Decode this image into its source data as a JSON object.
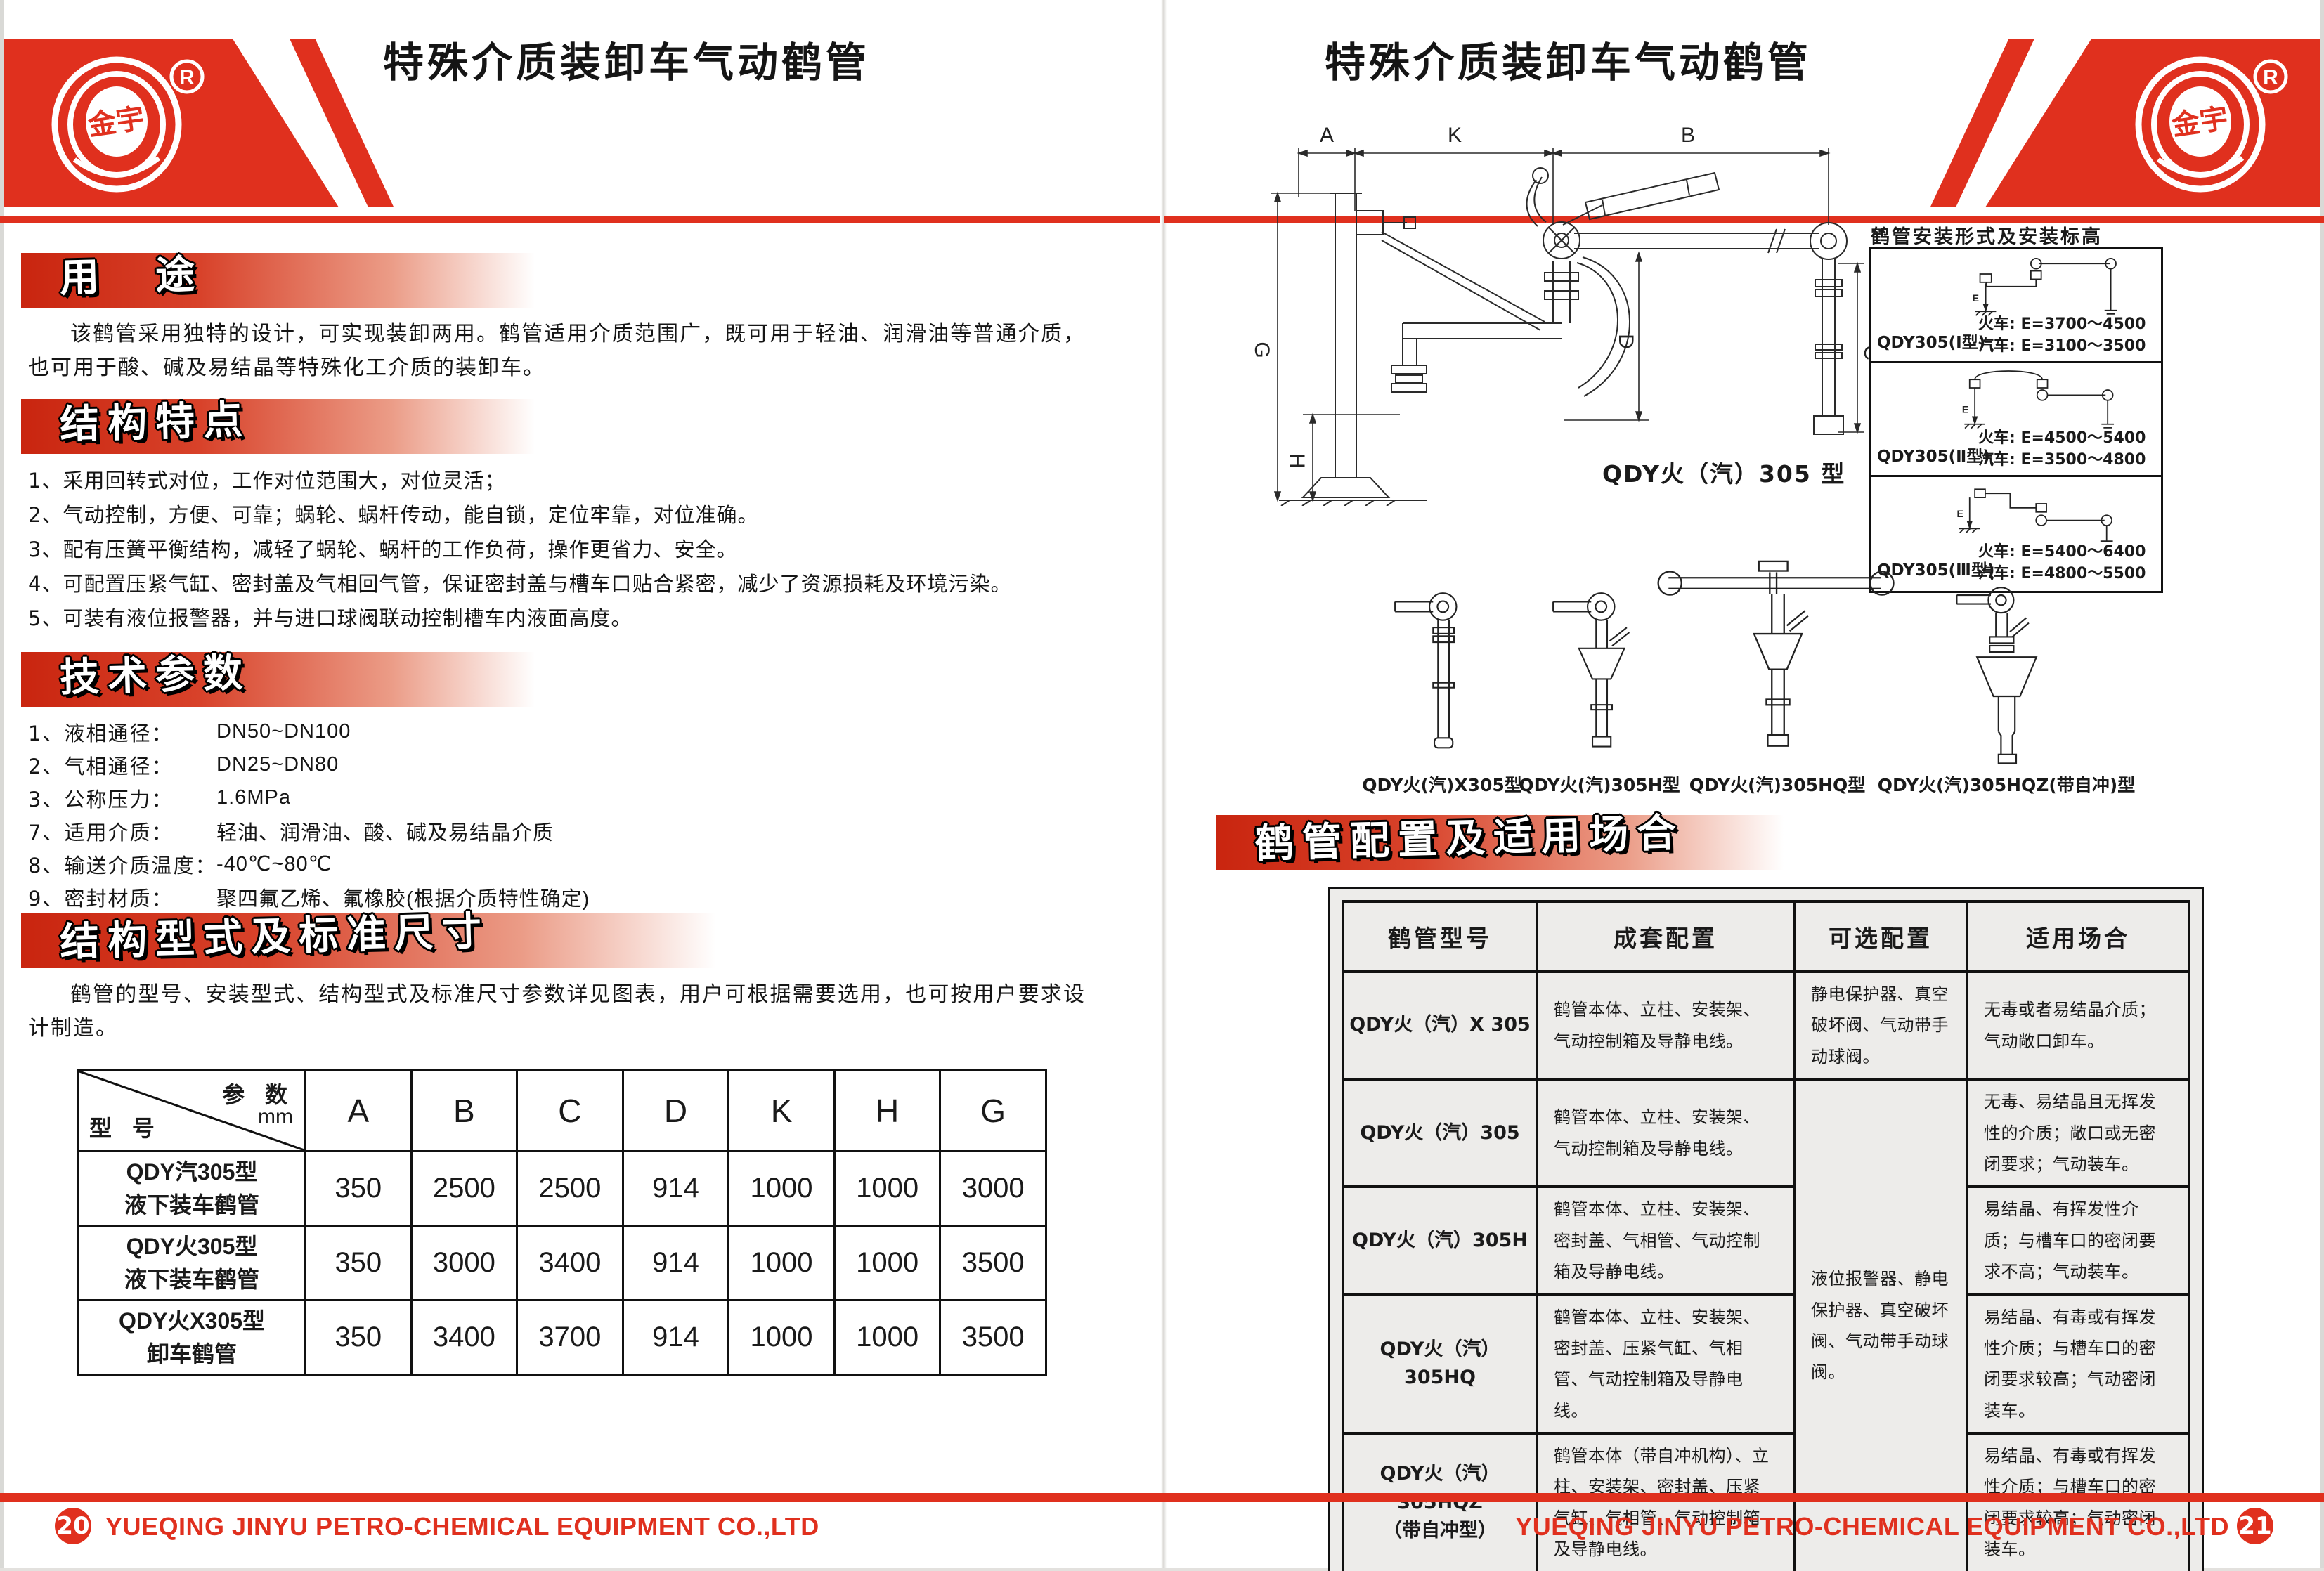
{
  "colors": {
    "accent_red": "#e0301e",
    "section_bar_red": "#c9250f",
    "table_gray": "#edecea",
    "line_black": "#111111"
  },
  "brand": {
    "logo_text": "金宇",
    "registered_mark": "R"
  },
  "left": {
    "title": "特殊介质装卸车气动鹤管",
    "usage": {
      "title": "用　途",
      "text": "该鹤管采用独特的设计，可实现装卸两用。鹤管适用介质范围广，既可用于轻油、润滑油等普通介质，也可用于酸、碱及易结晶等特殊化工介质的装卸车。"
    },
    "features": {
      "title": "结构特点",
      "items": [
        "1、采用回转式对位，工作对位范围大，对位灵活；",
        "2、气动控制，方便、可靠；蜗轮、蜗杆传动，能自锁，定位牢靠，对位准确。",
        "3、配有压簧平衡结构，减轻了蜗轮、蜗杆的工作负荷，操作更省力、安全。",
        "4、可配置压紧气缸、密封盖及气相回气管，保证密封盖与槽车口贴合紧密，减少了资源损耗及环境污染。",
        "5、可装有液位报警器，并与进口球阀联动控制槽车内液面高度。"
      ]
    },
    "params": {
      "title": "技术参数",
      "rows": [
        {
          "label": "1、液相通径：",
          "value": "DN50~DN100"
        },
        {
          "label": "2、气相通径：",
          "value": "DN25~DN80"
        },
        {
          "label": "3、公称压力：",
          "value": "1.6MPa"
        },
        {
          "label": "7、适用介质：",
          "value": "轻油、润滑油、酸、碱及易结晶介质"
        },
        {
          "label": "8、输送介质温度：",
          "value": "-40℃~80℃"
        },
        {
          "label": "9、密封材质：",
          "value": "聚四氟乙烯、氟橡胶(根据介质特性确定)"
        }
      ]
    },
    "structure": {
      "title": "结构型式及标准尺寸",
      "text": "鹤管的型号、安装型式、结构型式及标准尺寸参数详见图表，用户可根据需要选用，也可按用户要求设计制造。"
    },
    "dim_table": {
      "corner_top": "参 数",
      "corner_unit": "mm",
      "corner_bottom": "型 号",
      "columns": [
        "A",
        "B",
        "C",
        "D",
        "K",
        "H",
        "G"
      ],
      "rows": [
        {
          "model": "QDY汽305型\n液下装车鹤管",
          "values": [
            "350",
            "2500",
            "2500",
            "914",
            "1000",
            "1000",
            "3000"
          ]
        },
        {
          "model": "QDY火305型\n液下装车鹤管",
          "values": [
            "350",
            "3000",
            "3400",
            "914",
            "1000",
            "1000",
            "3500"
          ]
        },
        {
          "model": "QDY火X305型\n卸车鹤管",
          "values": [
            "350",
            "3400",
            "3700",
            "914",
            "1000",
            "1000",
            "3500"
          ]
        }
      ]
    },
    "footer": {
      "page": "20",
      "company": "YUEQING JINYU PETRO-CHEMICAL EQUIPMENT CO.,LTD"
    }
  },
  "right": {
    "title": "特殊介质装卸车气动鹤管",
    "drawing": {
      "caption": "QDY火（汽）305 型",
      "dim_a": "A",
      "dim_k": "K",
      "dim_b": "B",
      "dim_c": "C",
      "dim_d": "D",
      "dim_h": "H",
      "dim_g": "G"
    },
    "install": {
      "title": "鹤管安装形式及安装标高",
      "e_label": "E",
      "panels": [
        {
          "model": "QDY305(Ⅰ型)",
          "train": "火车: E=3700～4500",
          "truck": "汽车: E=3100～3500"
        },
        {
          "model": "QDY305(Ⅱ型)",
          "train": "火车: E=4500～5400",
          "truck": "汽车: E=3500～4800"
        },
        {
          "model": "QDY305(Ⅲ型)",
          "train": "火车: E=5400～6400",
          "truck": "汽车: E=4800～5500"
        }
      ]
    },
    "variants": {
      "labels": [
        "QDY火(汽)X305型",
        "QDY火(汽)305H型",
        "QDY火(汽)305HQ型",
        "QDY火(汽)305HQZ(带自冲)型"
      ]
    },
    "config": {
      "title": "鹤管配置及适用场合",
      "headers": [
        "鹤管型号",
        "成套配置",
        "可选配置",
        "适用场合"
      ],
      "rows": [
        {
          "model": "QDY火（汽）X 305",
          "set": "鹤管本体、立柱、安装架、气动控制箱及导静电线。",
          "optional": "静电保护器、真空破坏阀、气动带手动球阀。",
          "usage": "无毒或者易结晶介质；气动敞口卸车。"
        },
        {
          "model": "QDY火（汽）305",
          "set": "鹤管本体、立柱、安装架、气动控制箱及导静电线。",
          "usage": "无毒、易结晶且无挥发性的介质；敞口或无密闭要求；气动装车。"
        },
        {
          "model": "QDY火（汽）305H",
          "set": "鹤管本体、立柱、安装架、密封盖、气相管、气动控制箱及导静电线。",
          "usage": "易结晶、有挥发性介质；与槽车口的密闭要求不高；气动装车。"
        },
        {
          "model": "QDY火（汽）305HQ",
          "set": "鹤管本体、立柱、安装架、密封盖、压紧气缸、气相管、气动控制箱及导静电线。",
          "usage": "易结晶、有毒或有挥发性介质；与槽车口的密闭要求较高；气动密闭装车。"
        },
        {
          "model": "QDY火（汽）305HQZ\n（带自冲型）",
          "set": "鹤管本体（带自冲机构）、立柱、安装架、密封盖、压紧气缸、气相管、气动控制箱及导静电线。",
          "usage": "易结晶、有毒或有挥发性介质；与槽车口的密闭要求较高；气动密闭装车。"
        }
      ],
      "optional_merged": "液位报警器、静电保护器、真空破坏阀、气动带手动球阀。"
    },
    "footer": {
      "page": "21",
      "company": "YUEQING JINYU PETRO-CHEMICAL EQUIPMENT CO.,LTD"
    }
  }
}
